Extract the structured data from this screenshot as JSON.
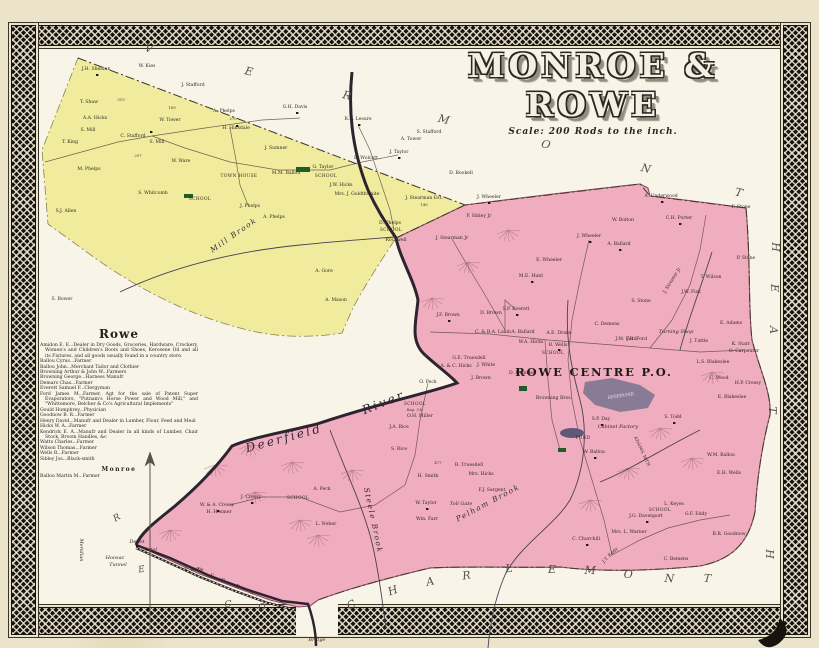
{
  "title": {
    "display": "MONROE & ROWE",
    "scale": "Scale: 200 Rods to the inch."
  },
  "colors": {
    "monroe_fill": "#f1eb9e",
    "rowe_fill": "#f0adc0",
    "rowe_edge": "#8c4a5e",
    "paper": "#ece3cb",
    "map_bg": "#f8f4e8",
    "ink": "#33291f",
    "border_band": "#17140f",
    "river": "#2e2430",
    "reservoir": "#7a7390",
    "pond": "#5f5878",
    "school_green": "#1e5c2a",
    "road": "#5d4a42",
    "boundary_dash": "#3f3a33"
  },
  "directory": {
    "rowe_title": "Rowe",
    "rowe_entries": [
      "Amidon E. E...Dealer in Dry Goods, Groceries, Hardware, Crockery, Women's and Children's Boots and Shoes, Kerosene Oil and all its Fixtures, and all goods usually found in a country store.",
      "Ballou Cyrus...Farmer",
      "Ballou John...Merchant Tailor and Clothier",
      "Browning Arthur & John W...Farmers",
      "Browning George...Harness Manufr",
      "Demars Chas...Farmer",
      "Everett Samuel F...Clergyman",
      "Ford James M...Farmer. Agt for the sale of Patent Super Evaporators, \"Putnam's Horse Power and Wood Mill,\" and \"Whittemore, Belcher & Co's Agricultural Implements\"",
      "Gould Humphrey...Physician",
      "Goodnow B. R...Farmer",
      "Henry David...Manufr and Dealer in Lumber, Flour, Feed and Meal",
      "Hicks W. A...Farmer",
      "Kendrick E. A...Manufr and Dealer in all kinds of Lumber, Chair Stock, Broom Handles, &c",
      "Watts Charles...Farmer",
      "Wilson Thomas...Farmer",
      "Wells R...Farmer",
      "Sibley Jos...Black-smith"
    ],
    "monroe_title": "Monroe",
    "monroe_entries": [
      "Ballou Martin M...Farmer"
    ]
  },
  "boundary_words": [
    {
      "name": "vermont",
      "cls": "bw",
      "letters": [
        {
          "t": "V",
          "x": 148,
          "y": 52,
          "r": 14
        },
        {
          "t": "E",
          "x": 248,
          "y": 75,
          "r": 14
        },
        {
          "t": "R",
          "x": 346,
          "y": 99,
          "r": 14
        },
        {
          "t": "M",
          "x": 443,
          "y": 123,
          "r": 14
        },
        {
          "t": "O",
          "x": 545,
          "y": 148,
          "r": 14
        },
        {
          "t": "N",
          "x": 645,
          "y": 172,
          "r": 14
        },
        {
          "t": "T",
          "x": 738,
          "y": 196,
          "r": 14
        }
      ]
    },
    {
      "name": "charlemont",
      "cls": "bw",
      "letters": [
        {
          "t": "C",
          "x": 353,
          "y": 608,
          "r": -28
        },
        {
          "t": "H",
          "x": 394,
          "y": 594,
          "r": -20
        },
        {
          "t": "A",
          "x": 431,
          "y": 585,
          "r": -14
        },
        {
          "t": "R",
          "x": 467,
          "y": 579,
          "r": -8
        },
        {
          "t": "L",
          "x": 509,
          "y": 572,
          "r": -3
        },
        {
          "t": "E",
          "x": 552,
          "y": 573,
          "r": 0
        },
        {
          "t": "M",
          "x": 590,
          "y": 574,
          "r": 2
        },
        {
          "t": "O",
          "x": 628,
          "y": 578,
          "r": 4
        },
        {
          "t": "N",
          "x": 669,
          "y": 582,
          "r": 5
        },
        {
          "t": "T",
          "x": 707,
          "y": 582,
          "r": 5
        }
      ]
    },
    {
      "name": "heath",
      "cls": "bw",
      "letters": [
        {
          "t": "H",
          "x": 772,
          "y": 247,
          "r": 90
        },
        {
          "t": "E",
          "x": 771,
          "y": 288,
          "r": 90
        },
        {
          "t": "A",
          "x": 770,
          "y": 330,
          "r": 90
        },
        {
          "t": "T",
          "x": 769,
          "y": 410,
          "r": 90
        },
        {
          "t": "H",
          "x": 766,
          "y": 554,
          "r": 90
        }
      ]
    },
    {
      "name": "berkshire-co",
      "cls": "bw2",
      "letters": [
        {
          "t": "R",
          "x": 118,
          "y": 520,
          "r": -30
        },
        {
          "t": "E",
          "x": 142,
          "y": 572,
          "r": -10
        },
        {
          "t": "C",
          "x": 228,
          "y": 607,
          "r": 0
        },
        {
          "t": "O",
          "x": 262,
          "y": 610,
          "r": 0
        }
      ]
    }
  ],
  "map_labels": [
    {
      "t": "ROWE CENTRE P.O.",
      "x": 594,
      "y": 376,
      "cls": "po"
    },
    {
      "t": "Deerfield",
      "x": 285,
      "y": 442,
      "cls": "riv",
      "r": -15
    },
    {
      "t": "River",
      "x": 385,
      "y": 406,
      "cls": "riv",
      "r": -22
    },
    {
      "t": "Pelham Brook",
      "x": 489,
      "y": 505,
      "cls": "brook",
      "r": -28
    },
    {
      "t": "Steele Brook",
      "x": 371,
      "y": 521,
      "cls": "brook",
      "r": 78,
      "s": 6.5
    },
    {
      "t": "Mill Brook",
      "x": 235,
      "y": 237,
      "cls": "brook",
      "r": -35,
      "s": 7
    },
    {
      "t": "Meridian",
      "x": 80,
      "y": 550,
      "cls": "f",
      "r": 90,
      "s": 7
    },
    {
      "t": "T. & G. R. R.",
      "x": 228,
      "y": 584,
      "cls": "f",
      "r": 23,
      "sp": 3
    },
    {
      "t": "Bridge",
      "x": 317,
      "y": 641,
      "cls": "f"
    },
    {
      "t": "Hoosac",
      "x": 115,
      "y": 559,
      "cls": "f"
    },
    {
      "t": "Tunnel",
      "x": 118,
      "y": 566,
      "cls": "f"
    },
    {
      "t": "Depot",
      "x": 137,
      "y": 543,
      "cls": "f",
      "s": 4.2
    },
    {
      "t": "Hotel",
      "x": 150,
      "y": 551,
      "cls": "f",
      "s": 4.2
    },
    {
      "t": "TOWN HOUSE",
      "x": 239,
      "y": 177,
      "cls": "cap"
    },
    {
      "t": "SCHOOL",
      "x": 200,
      "y": 200,
      "cls": "cap"
    },
    {
      "t": "SCHOOL",
      "x": 326,
      "y": 177,
      "cls": "cap"
    },
    {
      "t": "SCHOOL",
      "x": 391,
      "y": 231,
      "cls": "cap"
    },
    {
      "t": "SCHOOL",
      "x": 415,
      "y": 405,
      "cls": "cap"
    },
    {
      "t": "Bap. Ch.",
      "x": 415,
      "y": 411,
      "cls": "num"
    },
    {
      "t": "SCHOOL",
      "x": 298,
      "y": 499,
      "cls": "cap"
    },
    {
      "t": "SCHOOL",
      "x": 553,
      "y": 354,
      "cls": "cap"
    },
    {
      "t": "SCHOOL",
      "x": 660,
      "y": 511,
      "cls": "cap"
    },
    {
      "t": "RESERVOIR",
      "x": 621,
      "y": 397,
      "cls": "res",
      "r": -8
    },
    {
      "t": "POND",
      "x": 583,
      "y": 439,
      "cls": "cap",
      "s": 3.8
    },
    {
      "t": "Cabinet Factory",
      "x": 618,
      "y": 428,
      "cls": "f",
      "s": 4.3
    },
    {
      "t": "ADAMS MTN",
      "x": 641,
      "y": 452,
      "cls": "cap",
      "r": 65
    },
    {
      "t": "Toll Gate",
      "x": 461,
      "y": 505,
      "cls": "f",
      "s": 4.3
    },
    {
      "t": "Turning Shop",
      "x": 676,
      "y": 333,
      "cls": "f",
      "s": 4.2
    },
    {
      "t": "319",
      "x": 121,
      "y": 101,
      "cls": "num"
    },
    {
      "t": "169",
      "x": 172,
      "y": 109,
      "cls": "num"
    },
    {
      "t": "270",
      "x": 233,
      "y": 120,
      "cls": "num"
    },
    {
      "t": "297",
      "x": 138,
      "y": 157,
      "cls": "num"
    },
    {
      "t": "146",
      "x": 424,
      "y": 206,
      "cls": "num"
    },
    {
      "t": "477",
      "x": 438,
      "y": 464,
      "cls": "num"
    },
    {
      "t": "J.H. Sheldon",
      "x": 96,
      "y": 70,
      "cls": "n"
    },
    {
      "t": "W. Kies",
      "x": 147,
      "y": 67,
      "cls": "n"
    },
    {
      "t": "J. Stafford",
      "x": 193,
      "y": 86,
      "cls": "n"
    },
    {
      "t": "T. Shaw",
      "x": 89,
      "y": 103,
      "cls": "n"
    },
    {
      "t": "A.A. Hicks",
      "x": 95,
      "y": 119,
      "cls": "n"
    },
    {
      "t": "A. Phelps",
      "x": 224,
      "y": 112,
      "cls": "n"
    },
    {
      "t": "H. Hinsdale",
      "x": 236,
      "y": 129,
      "cls": "n"
    },
    {
      "t": "W. Tower",
      "x": 170,
      "y": 121,
      "cls": "n"
    },
    {
      "t": "S. Mill",
      "x": 88,
      "y": 131,
      "cls": "n"
    },
    {
      "t": "C. Stafford",
      "x": 133,
      "y": 137,
      "cls": "n"
    },
    {
      "t": "S. Mill",
      "x": 157,
      "y": 143,
      "cls": "n"
    },
    {
      "t": "T. King",
      "x": 70,
      "y": 143,
      "cls": "n"
    },
    {
      "t": "W. Ware",
      "x": 181,
      "y": 162,
      "cls": "n"
    },
    {
      "t": "M. Phelps",
      "x": 89,
      "y": 170,
      "cls": "n"
    },
    {
      "t": "S. Whitcomb",
      "x": 153,
      "y": 194,
      "cls": "n"
    },
    {
      "t": "M.M. Ballou",
      "x": 286,
      "y": 174,
      "cls": "n"
    },
    {
      "t": "S.J. Allen",
      "x": 66,
      "y": 212,
      "cls": "n"
    },
    {
      "t": "J. Phelps",
      "x": 250,
      "y": 207,
      "cls": "n"
    },
    {
      "t": "A. Phelps",
      "x": 274,
      "y": 218,
      "cls": "n"
    },
    {
      "t": "G.H. Davis",
      "x": 295,
      "y": 108,
      "cls": "n"
    },
    {
      "t": "R.E. Lesure",
      "x": 358,
      "y": 120,
      "cls": "n"
    },
    {
      "t": "J. Sumner",
      "x": 276,
      "y": 149,
      "cls": "n"
    },
    {
      "t": "E. Wolcott",
      "x": 366,
      "y": 159,
      "cls": "n"
    },
    {
      "t": "G. Taylor",
      "x": 323,
      "y": 168,
      "cls": "n"
    },
    {
      "t": "J. Taylor",
      "x": 399,
      "y": 153,
      "cls": "n"
    },
    {
      "t": "A. Tower",
      "x": 411,
      "y": 140,
      "cls": "n"
    },
    {
      "t": "S. Stafford",
      "x": 429,
      "y": 133,
      "cls": "n"
    },
    {
      "t": "J.W. Hicks",
      "x": 341,
      "y": 186,
      "cls": "n"
    },
    {
      "t": "Mrs. J. Goldthwaite",
      "x": 357,
      "y": 195,
      "cls": "n"
    },
    {
      "t": "J. Stearman Est.",
      "x": 424,
      "y": 199,
      "cls": "n"
    },
    {
      "t": "D. Bookell",
      "x": 461,
      "y": 174,
      "cls": "n"
    },
    {
      "t": "D. Phelps",
      "x": 390,
      "y": 224,
      "cls": "n"
    },
    {
      "t": "Rockwell",
      "x": 396,
      "y": 241,
      "cls": "n"
    },
    {
      "t": "A. Gore",
      "x": 324,
      "y": 272,
      "cls": "n"
    },
    {
      "t": "A. Mason",
      "x": 336,
      "y": 301,
      "cls": "n"
    },
    {
      "t": "S. Bower",
      "x": 62,
      "y": 300,
      "cls": "n"
    },
    {
      "t": "J. Wheeler",
      "x": 489,
      "y": 198,
      "cls": "n"
    },
    {
      "t": "P. Sibley Jr",
      "x": 479,
      "y": 217,
      "cls": "n"
    },
    {
      "t": "J. Stearman Jr",
      "x": 452,
      "y": 239,
      "cls": "n"
    },
    {
      "t": "A. Underwood",
      "x": 661,
      "y": 197,
      "cls": "n"
    },
    {
      "t": "W. Bolton",
      "x": 623,
      "y": 221,
      "cls": "n"
    },
    {
      "t": "C.H. Porter",
      "x": 679,
      "y": 219,
      "cls": "n"
    },
    {
      "t": "F. Stone",
      "x": 741,
      "y": 208,
      "cls": "n"
    },
    {
      "t": "P. Stone",
      "x": 746,
      "y": 259,
      "cls": "n"
    },
    {
      "t": "J. Wheeler",
      "x": 589,
      "y": 237,
      "cls": "n"
    },
    {
      "t": "A. Ballard",
      "x": 619,
      "y": 245,
      "cls": "n"
    },
    {
      "t": "E. Wheeler",
      "x": 549,
      "y": 261,
      "cls": "n"
    },
    {
      "t": "M.E. Hunt",
      "x": 531,
      "y": 277,
      "cls": "n"
    },
    {
      "t": "J. Streeter Jr",
      "x": 673,
      "y": 281,
      "cls": "n",
      "r": -58
    },
    {
      "t": "T. Wilson",
      "x": 711,
      "y": 278,
      "cls": "n"
    },
    {
      "t": "J.W. Fisk",
      "x": 691,
      "y": 293,
      "cls": "n"
    },
    {
      "t": "S. Stone",
      "x": 641,
      "y": 302,
      "cls": "n"
    },
    {
      "t": "E. Adams",
      "x": 731,
      "y": 324,
      "cls": "n"
    },
    {
      "t": "J. Tuttle",
      "x": 699,
      "y": 342,
      "cls": "n"
    },
    {
      "t": "K. Starr",
      "x": 741,
      "y": 345,
      "cls": "n"
    },
    {
      "t": "O. Carpenter",
      "x": 744,
      "y": 352,
      "cls": "n"
    },
    {
      "t": "J.B. Ford",
      "x": 637,
      "y": 340,
      "cls": "n"
    },
    {
      "t": "L.S. Blakeslee",
      "x": 713,
      "y": 363,
      "cls": "n"
    },
    {
      "t": "H.P. Cressy",
      "x": 748,
      "y": 384,
      "cls": "n"
    },
    {
      "t": "C. Wood",
      "x": 719,
      "y": 379,
      "cls": "n"
    },
    {
      "t": "E. Blakeslee",
      "x": 732,
      "y": 398,
      "cls": "n"
    },
    {
      "t": "S. Todd",
      "x": 673,
      "y": 418,
      "cls": "n"
    },
    {
      "t": "W.M. Ballou",
      "x": 721,
      "y": 456,
      "cls": "n"
    },
    {
      "t": "E.H. Wells",
      "x": 729,
      "y": 474,
      "cls": "n"
    },
    {
      "t": "S.P. Everett",
      "x": 516,
      "y": 310,
      "cls": "n"
    },
    {
      "t": "D. Brown",
      "x": 491,
      "y": 314,
      "cls": "n"
    },
    {
      "t": "J.F. Brown",
      "x": 448,
      "y": 316,
      "cls": "n"
    },
    {
      "t": "C. Demens",
      "x": 607,
      "y": 325,
      "cls": "n"
    },
    {
      "t": "C. & B.A. Lamb",
      "x": 493,
      "y": 333,
      "cls": "n"
    },
    {
      "t": "A. Ballard",
      "x": 523,
      "y": 333,
      "cls": "n"
    },
    {
      "t": "W.A. Hicks",
      "x": 531,
      "y": 343,
      "cls": "n"
    },
    {
      "t": "A.E. Drake",
      "x": 559,
      "y": 334,
      "cls": "n"
    },
    {
      "t": "J.M. Ford",
      "x": 626,
      "y": 340,
      "cls": "n"
    },
    {
      "t": "B. Wells",
      "x": 558,
      "y": 346,
      "cls": "n"
    },
    {
      "t": "G.E. Truesdell",
      "x": 469,
      "y": 359,
      "cls": "n"
    },
    {
      "t": "A. & C. Hicks",
      "x": 456,
      "y": 367,
      "cls": "n"
    },
    {
      "t": "J. White",
      "x": 486,
      "y": 366,
      "cls": "n"
    },
    {
      "t": "J. Brown",
      "x": 481,
      "y": 379,
      "cls": "n"
    },
    {
      "t": "D. Holmes",
      "x": 521,
      "y": 374,
      "cls": "n"
    },
    {
      "t": "O. Peck",
      "x": 428,
      "y": 383,
      "cls": "n"
    },
    {
      "t": "Browning Bros.",
      "x": 554,
      "y": 399,
      "cls": "n"
    },
    {
      "t": "S.P. Day",
      "x": 601,
      "y": 420,
      "cls": "n"
    },
    {
      "t": "W. Ballou",
      "x": 594,
      "y": 453,
      "cls": "n"
    },
    {
      "t": "O.H. Miller",
      "x": 420,
      "y": 417,
      "cls": "n"
    },
    {
      "t": "J.A. Rice",
      "x": 399,
      "y": 428,
      "cls": "n"
    },
    {
      "t": "S. Rice",
      "x": 399,
      "y": 450,
      "cls": "n"
    },
    {
      "t": "W. & A. Cressy",
      "x": 217,
      "y": 506,
      "cls": "n"
    },
    {
      "t": "H. Hosmer",
      "x": 219,
      "y": 513,
      "cls": "n"
    },
    {
      "t": "J. Cressy",
      "x": 251,
      "y": 498,
      "cls": "n"
    },
    {
      "t": "A. Peck",
      "x": 322,
      "y": 490,
      "cls": "n"
    },
    {
      "t": "L. Neher",
      "x": 326,
      "y": 525,
      "cls": "n"
    },
    {
      "t": "W. Taylor",
      "x": 426,
      "y": 504,
      "cls": "n"
    },
    {
      "t": "Wm. Farr",
      "x": 427,
      "y": 520,
      "cls": "n"
    },
    {
      "t": "H. Smith",
      "x": 428,
      "y": 477,
      "cls": "n"
    },
    {
      "t": "R. Truesdell",
      "x": 469,
      "y": 466,
      "cls": "n"
    },
    {
      "t": "Mrs. Hicks",
      "x": 481,
      "y": 475,
      "cls": "n"
    },
    {
      "t": "F.J. Sargent",
      "x": 492,
      "y": 491,
      "cls": "n"
    },
    {
      "t": "E. Kittle",
      "x": 194,
      "y": 571,
      "cls": "n"
    },
    {
      "t": "C. Churchill",
      "x": 586,
      "y": 540,
      "cls": "n"
    },
    {
      "t": "Mrs. L. Warner",
      "x": 629,
      "y": 533,
      "cls": "n"
    },
    {
      "t": "J.G. Davenport",
      "x": 646,
      "y": 517,
      "cls": "n"
    },
    {
      "t": "L. Keyes",
      "x": 674,
      "y": 505,
      "cls": "n"
    },
    {
      "t": "G.F. Eddy",
      "x": 696,
      "y": 515,
      "cls": "n"
    },
    {
      "t": "B.R. Goodnow",
      "x": 729,
      "y": 535,
      "cls": "n"
    },
    {
      "t": "C. Bemens",
      "x": 676,
      "y": 560,
      "cls": "n"
    },
    {
      "t": "J.T. Eddy",
      "x": 611,
      "y": 556,
      "cls": "n",
      "r": -45
    }
  ]
}
